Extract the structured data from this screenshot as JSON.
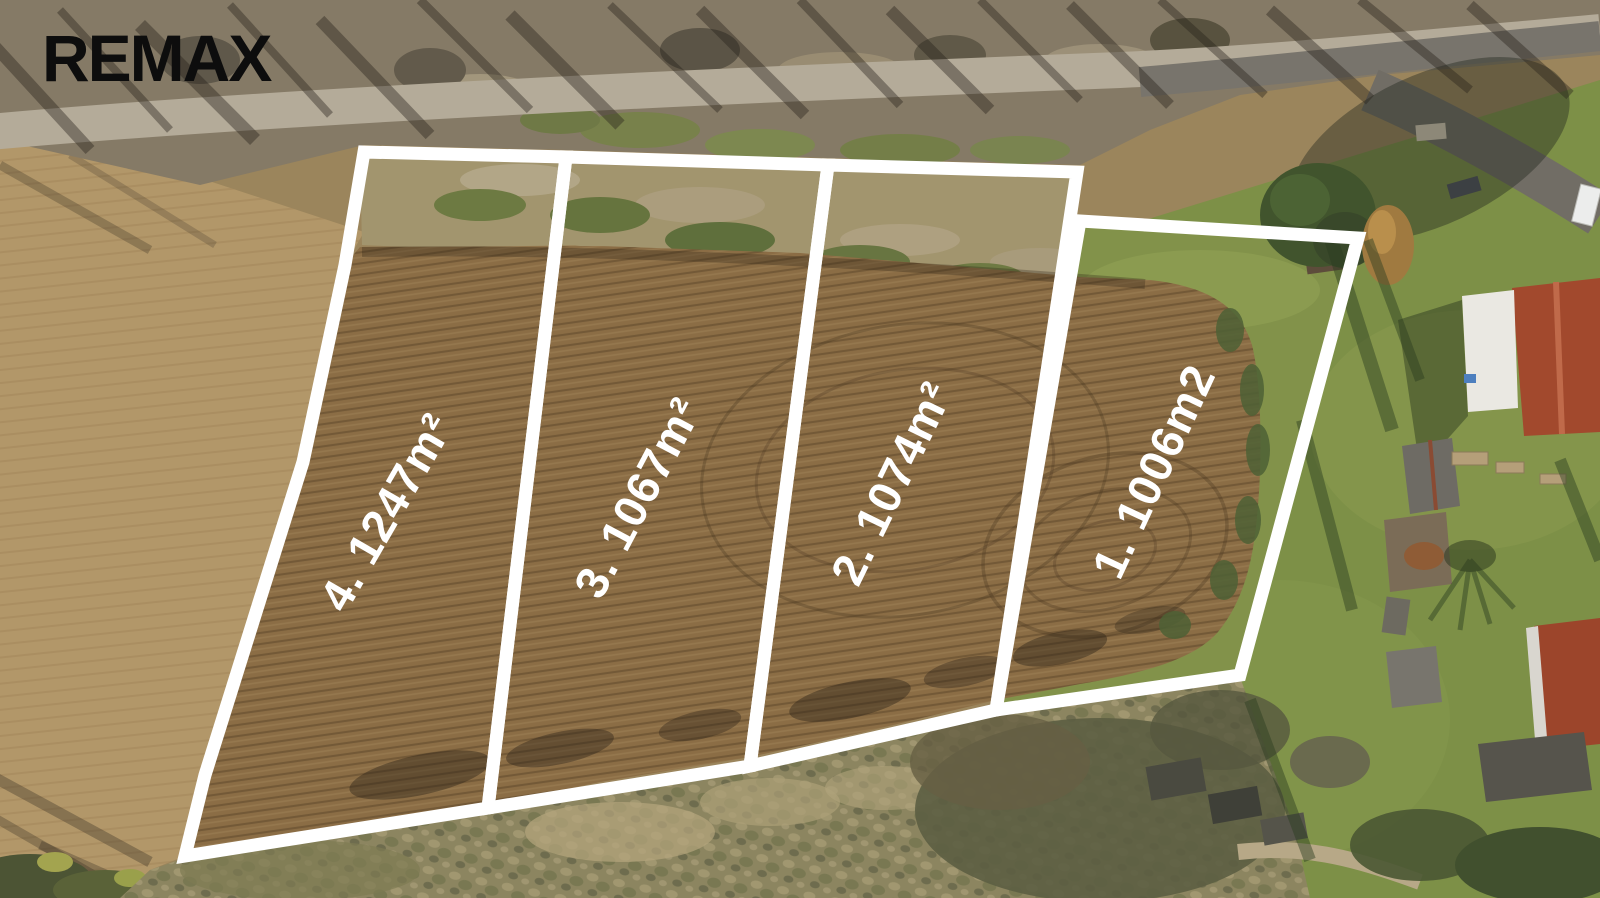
{
  "branding": {
    "logo": "REMAX",
    "logo_color": "#0d0d0d"
  },
  "overlay": {
    "outline_color": "#ffffff",
    "label_color": "#ffffff",
    "plots": [
      {
        "number": "4.",
        "area": "1247",
        "unit": "m²",
        "label": "4. 1247m²"
      },
      {
        "number": "3.",
        "area": "1067",
        "unit": "m²",
        "label": "3. 1067m²"
      },
      {
        "number": "2.",
        "area": "1074",
        "unit": "m²",
        "label": "2. 1074m²"
      },
      {
        "number": "1.",
        "area": "1006",
        "unit": "m2",
        "label": "1. 1006m2"
      }
    ]
  }
}
